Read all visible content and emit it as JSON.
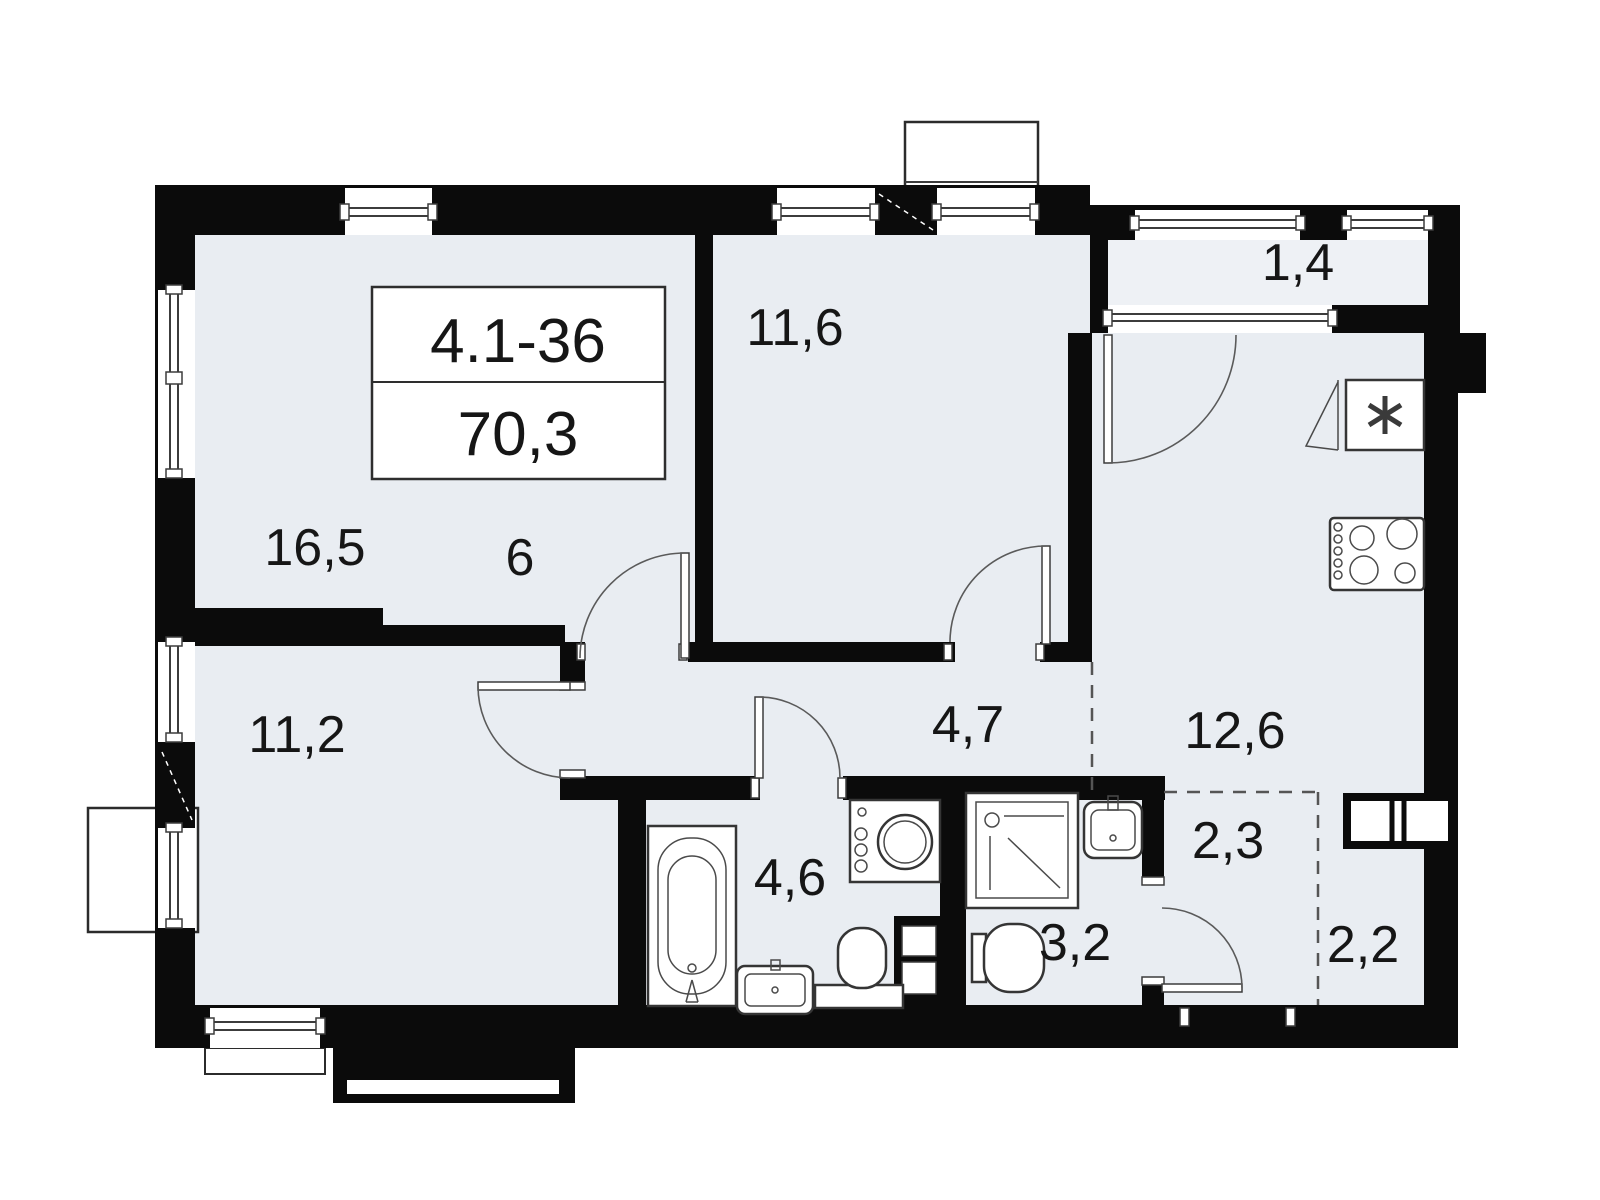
{
  "plan": {
    "unit_label": "4.1-36",
    "total_area": "70,3",
    "rooms": [
      {
        "id": "living-room",
        "label": "16,5"
      },
      {
        "id": "kitchen-niche",
        "label": "6"
      },
      {
        "id": "bedroom-top",
        "label": "11,6"
      },
      {
        "id": "balcony",
        "label": "1,4"
      },
      {
        "id": "kitchen-living",
        "label": "12,6"
      },
      {
        "id": "bedroom-bottom",
        "label": "11,2"
      },
      {
        "id": "hallway",
        "label": "4,7"
      },
      {
        "id": "bathroom",
        "label": "4,6"
      },
      {
        "id": "shower-room",
        "label": "3,2"
      },
      {
        "id": "entry-hall",
        "label": "2,3"
      },
      {
        "id": "wardrobe",
        "label": "2,2"
      }
    ],
    "fixtures": [
      "fridge-icon",
      "stove-icon",
      "bathtub-icon",
      "washing-machine-icon",
      "sink-icon",
      "toilet-icon",
      "shower-cabin-icon",
      "wardrobe-icon"
    ],
    "colors": {
      "floor": "#e9edf2",
      "wall": "#0b0b0b",
      "line": "#3c3c3c",
      "background": "#ffffff"
    }
  }
}
